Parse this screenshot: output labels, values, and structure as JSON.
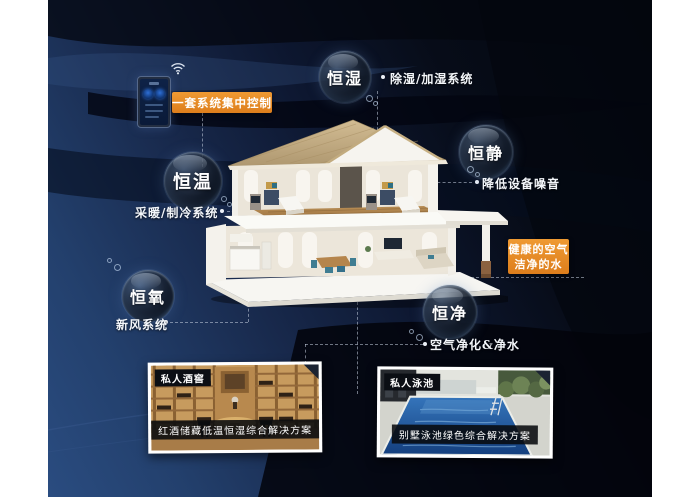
{
  "control_phone": {
    "label": "一套系统集中控制"
  },
  "bubbles": {
    "humidity": {
      "label": "恒湿",
      "system": "除湿/加湿系统"
    },
    "quiet": {
      "label": "恒静",
      "system": "降低设备噪音"
    },
    "temperature": {
      "label": "恒温",
      "system": "采暖/制冷系统"
    },
    "oxygen": {
      "label": "恒氧",
      "system": "新风系统"
    },
    "purity": {
      "label": "恒净",
      "system": "空气净化&净水"
    }
  },
  "callout_air_water": {
    "line1": "健康的空气",
    "line2": "洁净的水"
  },
  "photos": {
    "wine_cellar": {
      "tag": "私人酒窖",
      "caption": "红酒储藏低温恒湿综合解决方案"
    },
    "pool": {
      "tag": "私人泳池",
      "caption": "别墅泳池绿色综合解决方案"
    }
  },
  "colors": {
    "accent_orange": "#e1861f",
    "background_navy": "#23406d",
    "background_dark": "#060b16",
    "bubble_text": "#ffffff"
  }
}
